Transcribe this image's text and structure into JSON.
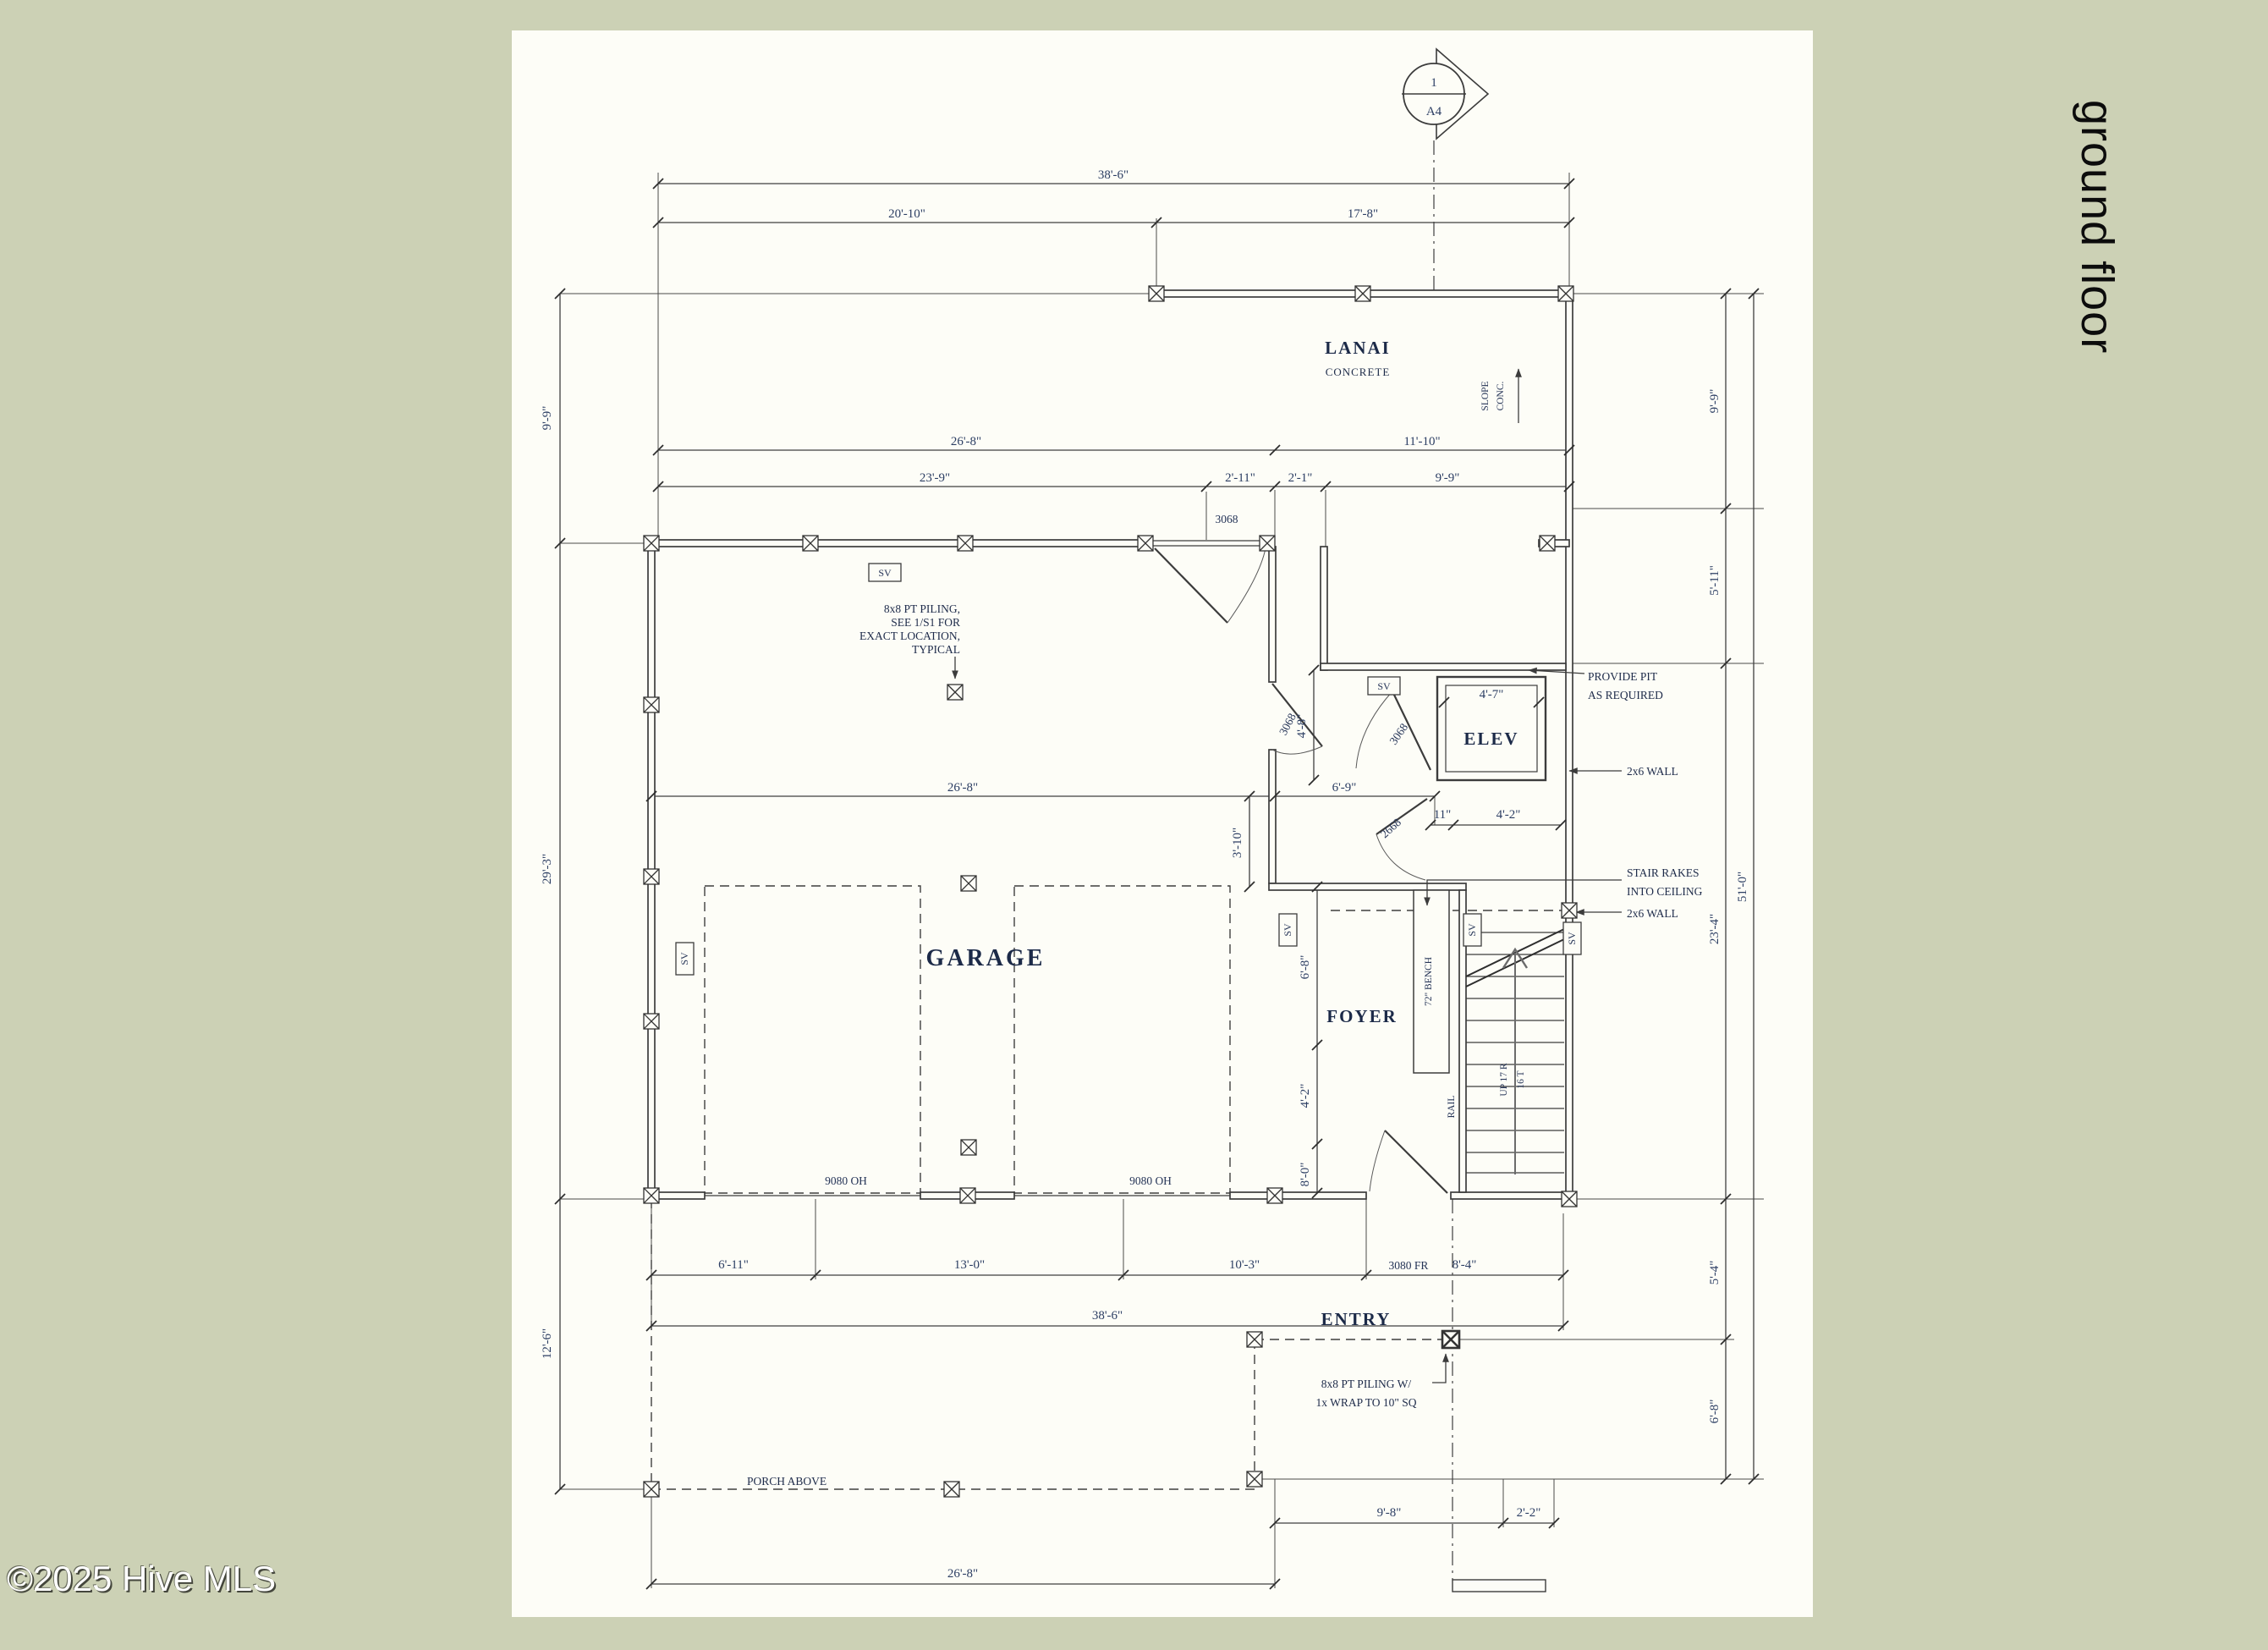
{
  "page": {
    "background": "#ccd1b5",
    "sheet_color": "#fdfdf7",
    "accent_text_color": "#2c3e63",
    "side_label": "ground floor",
    "watermark": "©2025 Hive MLS"
  },
  "section_marker": {
    "number": "1",
    "sheet": "A4"
  },
  "rooms": {
    "lanai": "LANAI",
    "lanai_sub": "CONCRETE",
    "slope_l1": "SLOPE",
    "slope_l2": "CONC.",
    "garage": "GARAGE",
    "elev": "ELEV",
    "foyer": "FOYER",
    "entry": "ENTRY",
    "porch_above": "PORCH ABOVE",
    "bench": "72\" BENCH",
    "rail": "RAIL",
    "up_l1": "UP 17 R",
    "up_l2": "16 T"
  },
  "notes": {
    "piling_l1": "8x8 PT PILING,",
    "piling_l2": "SEE 1/S1 FOR",
    "piling_l3": "EXACT LOCATION,",
    "piling_l4": "TYPICAL",
    "pit_l1": "PROVIDE PIT",
    "pit_l2": "AS REQUIRED",
    "wall_2x6": "2x6 WALL",
    "stair_l1": "STAIR RAKES",
    "stair_l2": "INTO CEILING",
    "entry_piling_l1": "8x8 PT PILING W/",
    "entry_piling_l2": "1x WRAP TO 10\" SQ",
    "sv": "SV"
  },
  "doors": {
    "door_3068": "3068",
    "door_2668": "2668",
    "door_9080": "9080 OH",
    "door_3080": "3080 FR"
  },
  "dims": {
    "ft38_6": "38'-6\"",
    "ft20_10": "20'-10\"",
    "ft17_8": "17'-8\"",
    "ft26_8": "26'-8\"",
    "ft11_10": "11'-10\"",
    "ft23_9": "23'-9\"",
    "ft2_11": "2'-11\"",
    "ft2_1": "2'-1\"",
    "ft9_9": "9'-9\"",
    "ft29_3": "29'-3\"",
    "ft12_6": "12'-6\"",
    "ft5_11": "5'-11\"",
    "ft23_4": "23'-4\"",
    "ft5_4": "5'-4\"",
    "ft6_8": "6'-8\"",
    "ft51_0": "51'-0\"",
    "ft6_9": "6'-9\"",
    "ft3_10": "3'-10\"",
    "ft4_8": "4'-8\"",
    "in11": "11\"",
    "ft4_2": "4'-2\"",
    "ft4_7": "4'-7\"",
    "ft8_0": "8'-0\"",
    "ft6_11": "6'-11\"",
    "ft13_0": "13'-0\"",
    "ft10_3": "10'-3\"",
    "ft8_4": "8'-4\"",
    "ft9_8": "9'-8\"",
    "ft2_2": "2'-2\"",
    "ft38_6b": "38'-6\""
  }
}
